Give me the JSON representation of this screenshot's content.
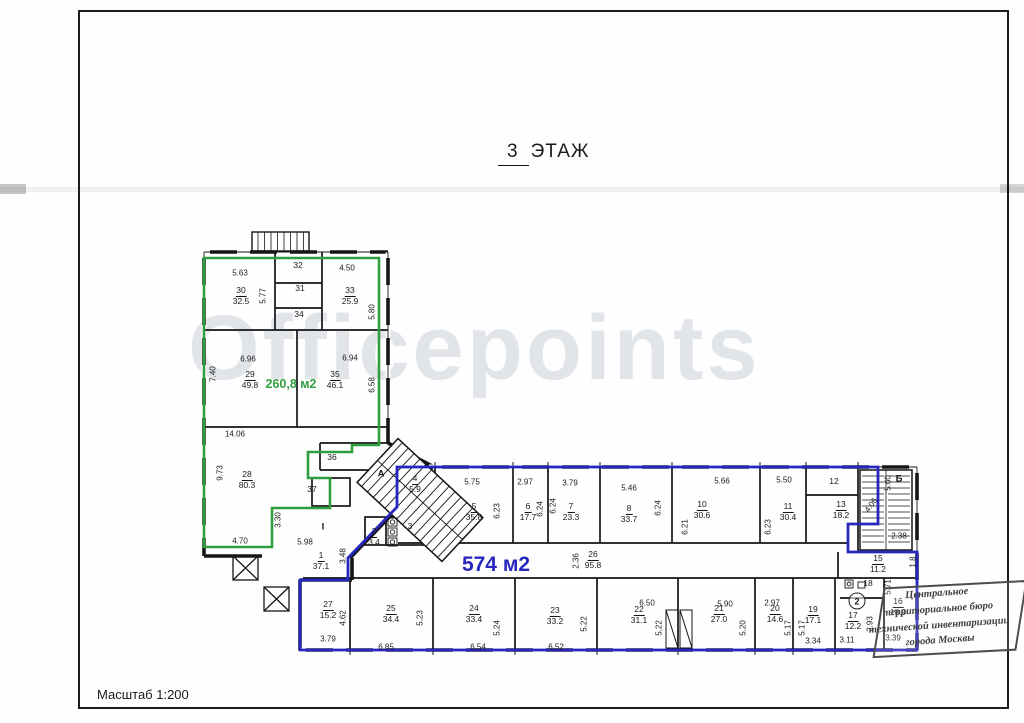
{
  "page": {
    "title_num": "3",
    "title_word": "ЭТАЖ",
    "scale_label": "Масштаб 1:200",
    "watermark": "Officepoints"
  },
  "zones": {
    "green": {
      "area_label": "260,8 м2",
      "color": "#2f9e3f"
    },
    "blue": {
      "area_label": "574 м2",
      "color": "#2727bd"
    }
  },
  "stamp": {
    "lines": [
      "Центральное",
      "территориальное бюро",
      "технической инвентаризации",
      "города Москвы"
    ]
  },
  "plan": {
    "rooms": [
      {
        "num": "30",
        "area": "32.5",
        "x": 241,
        "y": 296
      },
      {
        "num": "31",
        "area": null,
        "x": 300,
        "y": 289
      },
      {
        "num": "32",
        "area": null,
        "x": 298,
        "y": 266
      },
      {
        "num": "33",
        "area": "25.9",
        "x": 350,
        "y": 296
      },
      {
        "num": "34",
        "area": null,
        "x": 299,
        "y": 315
      },
      {
        "num": "29",
        "area": "49.8",
        "x": 250,
        "y": 380
      },
      {
        "num": "35",
        "area": "46.1",
        "x": 335,
        "y": 380
      },
      {
        "num": "28",
        "area": "80.3",
        "x": 247,
        "y": 480
      },
      {
        "num": "36",
        "area": null,
        "x": 332,
        "y": 458
      },
      {
        "num": "37",
        "area": null,
        "x": 312,
        "y": 490
      },
      {
        "num": "1",
        "area": "37.1",
        "x": 321,
        "y": 561
      },
      {
        "num": "2",
        "area": "3.4",
        "x": 374,
        "y": 537
      },
      {
        "num": "3",
        "area": null,
        "x": 410,
        "y": 527
      },
      {
        "num": "4",
        "area": "5.9",
        "x": 415,
        "y": 484
      },
      {
        "num": "5",
        "area": "35.8",
        "x": 474,
        "y": 512
      },
      {
        "num": "6",
        "area": "17.7",
        "x": 528,
        "y": 512
      },
      {
        "num": "7",
        "area": "23.3",
        "x": 571,
        "y": 512
      },
      {
        "num": "8",
        "area": "33.7",
        "x": 629,
        "y": 514
      },
      {
        "num": "10",
        "area": "30.6",
        "x": 702,
        "y": 510
      },
      {
        "num": "11",
        "area": "30.4",
        "x": 788,
        "y": 512
      },
      {
        "num": "12",
        "area": null,
        "x": 834,
        "y": 482
      },
      {
        "num": "13",
        "area": "18.2",
        "x": 841,
        "y": 510
      },
      {
        "num": "15",
        "area": "11.2",
        "x": 878,
        "y": 564
      },
      {
        "num": "16",
        "area": "18.9",
        "x": 898,
        "y": 607
      },
      {
        "num": "17",
        "area": "12.2",
        "x": 853,
        "y": 621
      },
      {
        "num": "18",
        "area": null,
        "x": 868,
        "y": 584
      },
      {
        "num": "19",
        "area": "17.1",
        "x": 813,
        "y": 615
      },
      {
        "num": "20",
        "area": "14.6",
        "x": 775,
        "y": 614
      },
      {
        "num": "21",
        "area": "27.0",
        "x": 719,
        "y": 614
      },
      {
        "num": "22",
        "area": "31.1",
        "x": 639,
        "y": 615
      },
      {
        "num": "23",
        "area": "33.2",
        "x": 555,
        "y": 616
      },
      {
        "num": "24",
        "area": "33.4",
        "x": 474,
        "y": 614
      },
      {
        "num": "25",
        "area": "34.4",
        "x": 391,
        "y": 614
      },
      {
        "num": "26",
        "area": "95.8",
        "x": 593,
        "y": 560
      },
      {
        "num": "27",
        "area": "15.2",
        "x": 328,
        "y": 610
      }
    ],
    "dims": [
      {
        "t": "5.63",
        "x": 240,
        "y": 273,
        "r": 0
      },
      {
        "t": "4.50",
        "x": 347,
        "y": 268,
        "r": 0
      },
      {
        "t": "5.77",
        "x": 263,
        "y": 296,
        "r": -90
      },
      {
        "t": "5.80",
        "x": 372,
        "y": 312,
        "r": -90
      },
      {
        "t": "6.96",
        "x": 248,
        "y": 359,
        "r": 0
      },
      {
        "t": "6.94",
        "x": 350,
        "y": 358,
        "r": 0
      },
      {
        "t": "7.40",
        "x": 213,
        "y": 374,
        "r": -90
      },
      {
        "t": "6.58",
        "x": 372,
        "y": 385,
        "r": -90
      },
      {
        "t": "14.06",
        "x": 235,
        "y": 434,
        "r": 0
      },
      {
        "t": "9.73",
        "x": 220,
        "y": 473,
        "r": -90
      },
      {
        "t": "3.30",
        "x": 278,
        "y": 520,
        "r": -90
      },
      {
        "t": "4.70",
        "x": 240,
        "y": 541,
        "r": 0
      },
      {
        "t": "5.98",
        "x": 305,
        "y": 542,
        "r": 0
      },
      {
        "t": "3.48",
        "x": 343,
        "y": 556,
        "r": -90
      },
      {
        "t": "2.36",
        "x": 576,
        "y": 561,
        "r": -90
      },
      {
        "t": "5.75",
        "x": 472,
        "y": 482,
        "r": 0
      },
      {
        "t": "6.23",
        "x": 497,
        "y": 511,
        "r": -90
      },
      {
        "t": "2.97",
        "x": 525,
        "y": 482,
        "r": 0
      },
      {
        "t": "6.24",
        "x": 540,
        "y": 509,
        "r": -90
      },
      {
        "t": "6.24",
        "x": 553,
        "y": 506,
        "r": -90
      },
      {
        "t": "3.79",
        "x": 570,
        "y": 483,
        "r": 0
      },
      {
        "t": "5.46",
        "x": 629,
        "y": 488,
        "r": 0
      },
      {
        "t": "6.24",
        "x": 658,
        "y": 508,
        "r": -90
      },
      {
        "t": "6.21",
        "x": 685,
        "y": 527,
        "r": -90
      },
      {
        "t": "5.66",
        "x": 722,
        "y": 481,
        "r": 0
      },
      {
        "t": "6.23",
        "x": 768,
        "y": 527,
        "r": -90
      },
      {
        "t": "5.50",
        "x": 784,
        "y": 480,
        "r": 0
      },
      {
        "t": "5.60",
        "x": 888,
        "y": 483,
        "r": -90
      },
      {
        "t": "2.38",
        "x": 899,
        "y": 536,
        "r": 0
      },
      {
        "t": "4.06",
        "x": 871,
        "y": 505,
        "r": -55
      },
      {
        "t": "1.8",
        "x": 913,
        "y": 562,
        "r": -90
      },
      {
        "t": "5.71",
        "x": 888,
        "y": 587,
        "r": -90
      },
      {
        "t": "2.93",
        "x": 870,
        "y": 624,
        "r": -90
      },
      {
        "t": "3.11",
        "x": 847,
        "y": 640,
        "r": 0
      },
      {
        "t": "3.39",
        "x": 893,
        "y": 638,
        "r": 0
      },
      {
        "t": "4.62",
        "x": 343,
        "y": 618,
        "r": -90
      },
      {
        "t": "3.79",
        "x": 328,
        "y": 639,
        "r": 0
      },
      {
        "t": "5.23",
        "x": 420,
        "y": 618,
        "r": -90
      },
      {
        "t": "6.85",
        "x": 386,
        "y": 647,
        "r": 0
      },
      {
        "t": "5.24",
        "x": 497,
        "y": 628,
        "r": -90
      },
      {
        "t": "6.54",
        "x": 478,
        "y": 647,
        "r": 0
      },
      {
        "t": "5.22",
        "x": 584,
        "y": 624,
        "r": -90
      },
      {
        "t": "6.52",
        "x": 556,
        "y": 647,
        "r": 0
      },
      {
        "t": "6.50",
        "x": 647,
        "y": 603,
        "r": 0
      },
      {
        "t": "5.22",
        "x": 659,
        "y": 628,
        "r": -90
      },
      {
        "t": "5.90",
        "x": 725,
        "y": 604,
        "r": 0
      },
      {
        "t": "5.20",
        "x": 743,
        "y": 628,
        "r": -90
      },
      {
        "t": "2.97",
        "x": 772,
        "y": 603,
        "r": 0
      },
      {
        "t": "5.17",
        "x": 788,
        "y": 628,
        "r": -90
      },
      {
        "t": "5.17",
        "x": 802,
        "y": 628,
        "r": -90
      },
      {
        "t": "3.34",
        "x": 813,
        "y": 641,
        "r": 0
      }
    ],
    "marks": [
      {
        "t": "А",
        "x": 381,
        "y": 474,
        "style": "plain"
      },
      {
        "t": "Б",
        "x": 899,
        "y": 479,
        "style": "plain"
      },
      {
        "t": "I",
        "x": 323,
        "y": 527,
        "style": "plain"
      },
      {
        "t": "2",
        "x": 857,
        "y": 601,
        "style": "circle"
      }
    ]
  }
}
